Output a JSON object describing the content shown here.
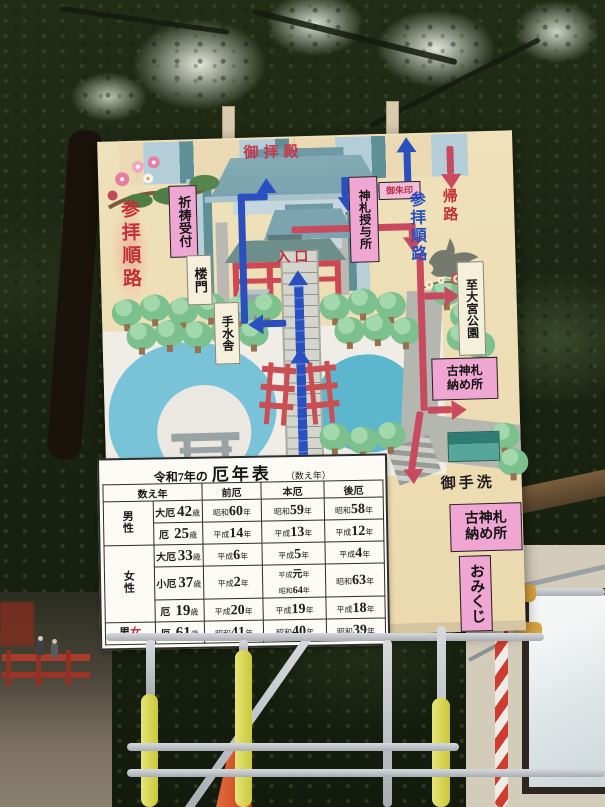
{
  "sign": {
    "map_labels": {
      "worship_hall": "御拝殿",
      "prayer_reception": "祈祷受付",
      "route_left": "参拝順路",
      "amulet_office": "神札授与所",
      "red_seal": "御朱印",
      "return_path": "帰路",
      "route_right": "参拝順路",
      "to_park_dest": "至大宮公園",
      "tower_gate": "楼門",
      "entrance": "入口",
      "water_pavilion": "手水舎",
      "old_amulet_line1": "古神札",
      "old_amulet_line2": "納め所",
      "restroom": "御手洗"
    },
    "board_labels": {
      "old_amulet_line1": "古神札",
      "old_amulet_line2": "納め所",
      "omikuji": "おみくじ"
    },
    "table": {
      "title_prefix": "令和7年の",
      "title_main": "厄年表",
      "note": "（数え年）",
      "columns": [
        "数え年",
        "前厄",
        "本厄",
        "後厄"
      ],
      "age_suffix": "歳",
      "year_suffix": "年",
      "groups": [
        {
          "label": "男性",
          "red": false,
          "rows": [
            {
              "kind": "大厄",
              "age": "42",
              "mae": [
                [
                  "昭和",
                  "60"
                ]
              ],
              "hon": [
                [
                  "昭和",
                  "59"
                ]
              ],
              "ato": [
                [
                  "昭和",
                  "58"
                ]
              ]
            },
            {
              "kind": "厄",
              "age": "25",
              "mae": [
                [
                  "平成",
                  "14"
                ]
              ],
              "hon": [
                [
                  "平成",
                  "13"
                ]
              ],
              "ato": [
                [
                  "平成",
                  "12"
                ]
              ]
            }
          ]
        },
        {
          "label": "女性",
          "red": true,
          "rows": [
            {
              "kind": "大厄",
              "age": "33",
              "mae": [
                [
                  "平成",
                  "6"
                ]
              ],
              "hon": [
                [
                  "平成",
                  "5"
                ]
              ],
              "ato": [
                [
                  "平成",
                  "4"
                ]
              ]
            },
            {
              "kind": "小厄",
              "age": "37",
              "mae": [
                [
                  "平成",
                  "2"
                ]
              ],
              "hon": [
                [
                  "平成",
                  "元"
                ],
                [
                  "昭和",
                  "64"
                ]
              ],
              "ato": [
                [
                  "昭和",
                  "63"
                ]
              ]
            },
            {
              "kind": "厄",
              "age": "19",
              "mae": [
                [
                  "平成",
                  "20"
                ]
              ],
              "hon": [
                [
                  "平成",
                  "19"
                ]
              ],
              "ato": [
                [
                  "平成",
                  "18"
                ]
              ]
            }
          ]
        },
        {
          "label": "男女",
          "red": false,
          "chars": [
            {
              "ch": "男",
              "red": false
            },
            {
              "ch": "女",
              "red": true
            }
          ],
          "rows": [
            {
              "kind": "厄",
              "age": "61",
              "mae": [
                [
                  "昭和",
                  "41"
                ]
              ],
              "hon": [
                [
                  "昭和",
                  "40"
                ]
              ],
              "ato": [
                [
                  "昭和",
                  "39"
                ]
              ]
            }
          ]
        }
      ]
    },
    "colors": {
      "sign_background": "#ecdbb2",
      "route_red": "#c84a5e",
      "route_blue": "#2a50c0",
      "label_pink": "#f0a6d2",
      "pond_blue": "#79c3d9",
      "tree_green": "#7cc08e",
      "roof_teal": "#7fa9b4",
      "honyaku_red": "#bf2433"
    }
  }
}
